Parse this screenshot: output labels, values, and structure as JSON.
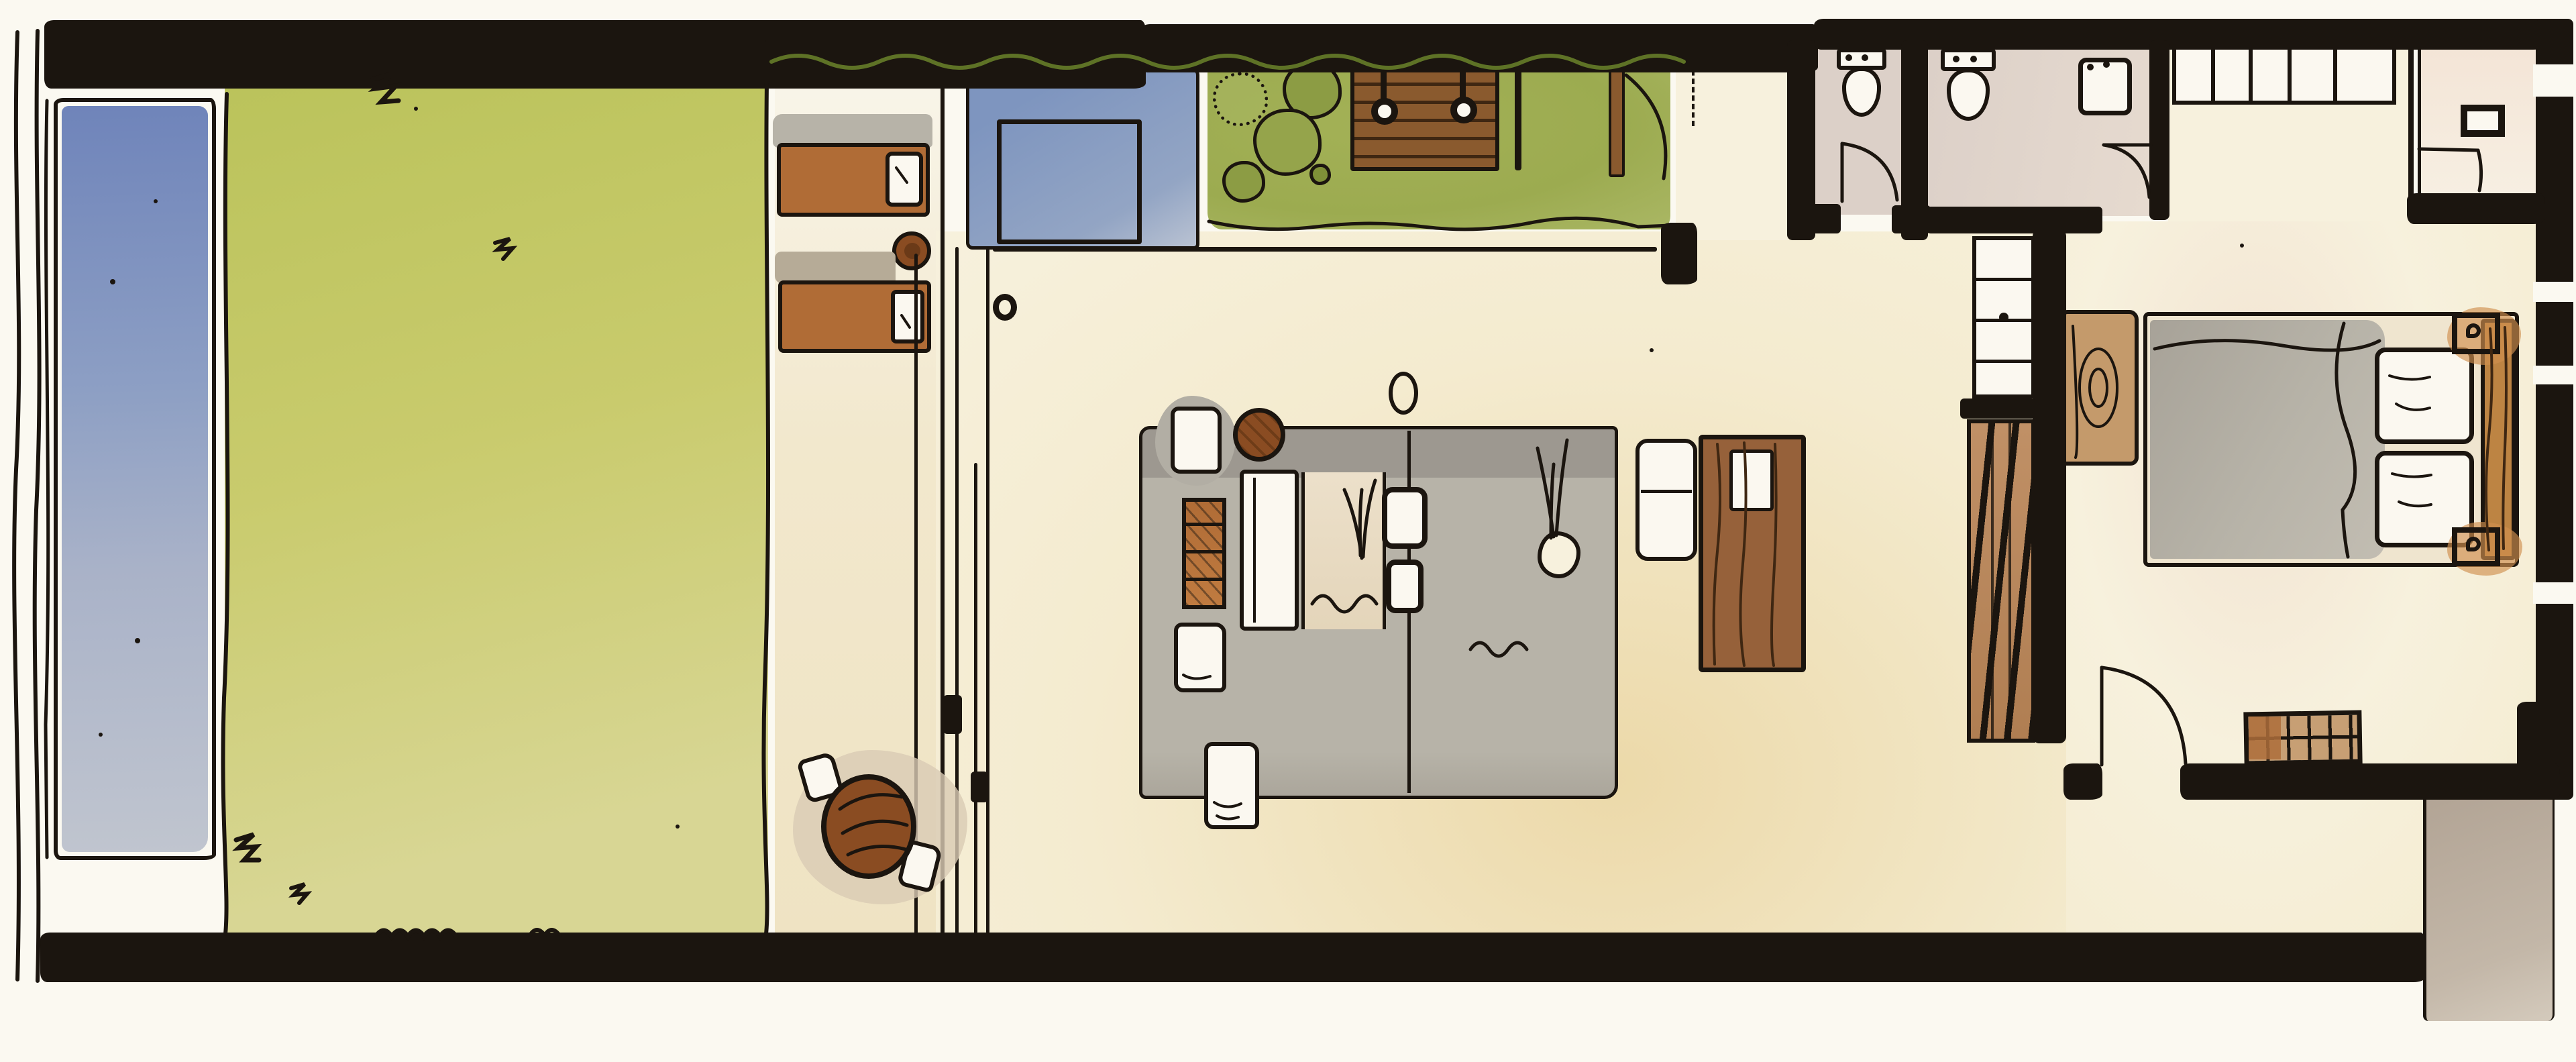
{
  "meta": {
    "title": "Hand-drawn ink and watercolor floor plan of a pool villa suite",
    "medium": "watercolor + ink sketch",
    "visible_text": "none"
  },
  "palette": {
    "paper": "#fbf9f1",
    "ink": "#1b150f",
    "cream": "#f4ebcf",
    "cream_warm": "#ecd9a9",
    "cream_pale": "#f7f1dd",
    "lawn": "#c9cb6d",
    "lawn_top": "#b9c259",
    "lawn_light": "#d8d694",
    "garden": "#a3b156",
    "hedge": "#8fa844",
    "hedge_dark": "#5e7226",
    "bush": "#8c9c44",
    "pool_deep": "#6f84ba",
    "pool_mid": "#8d9fc4",
    "pool_pale": "#c0c5cf",
    "daybed_blue": "#7e95bf",
    "daybed_blue2": "#93a5c4",
    "rug": "#b7b3a8",
    "rug_dark": "#9d9890",
    "orange": "#b06c36",
    "orange_light": "#cf8f4f",
    "wood_deck": "#8a5a2e",
    "wood_dark": "#3f2712",
    "wood_table": "#8a4c22",
    "wood_desk": "#96613a",
    "slab": "#c49a6b",
    "headboard": "#bd8443",
    "ladder_wood": "#c09066",
    "mauve": "#dcd0c8",
    "porch": "#b2a495",
    "bench_tan": "#c79f74",
    "bench_brown": "#ad6d3b",
    "white_wash": "#fbf8f0",
    "pink_wash": "#f3e4d6"
  },
  "rooms": {
    "pool": {
      "label": "Lap pool"
    },
    "lawn": {
      "label": "Lawn"
    },
    "terrace": {
      "label": "Sun lounger terrace"
    },
    "daybed": {
      "label": "Outdoor daybed"
    },
    "garden": {
      "label": "Garden court with outdoor shower deck"
    },
    "living": {
      "label": "Living / sitting room"
    },
    "passage": {
      "label": "Garden passage"
    },
    "wc": {
      "label": "WC"
    },
    "bath": {
      "label": "Bathroom"
    },
    "hall": {
      "label": "Hallway"
    },
    "bedroom": {
      "label": "Bedroom"
    },
    "closet": {
      "label": "Wardrobe closet"
    },
    "dressing": {
      "label": "Dressing room"
    },
    "porch": {
      "label": "Entry porch"
    }
  },
  "inventory": {
    "sun_loungers": 2,
    "lounger_side_table": 1,
    "outdoor_shower_heads": 2,
    "garden_bushes": 5,
    "outdoor_dining_table_seats": 2,
    "sliding_glass_door_tracks": 4,
    "living_armchairs": 4,
    "sofa": 1,
    "storage_ottoman": 1,
    "round_side_table": 1,
    "desk": 1,
    "desk_bench": 1,
    "plants": 2,
    "toilets": 2,
    "washbasin": 1,
    "bed": 1,
    "bed_pillows": 2,
    "nightstand_lamps": 2,
    "foot_bench": 1,
    "wood_slab_bench": 1,
    "slatted_shelf_unit": 1,
    "interior_doors": 4
  }
}
